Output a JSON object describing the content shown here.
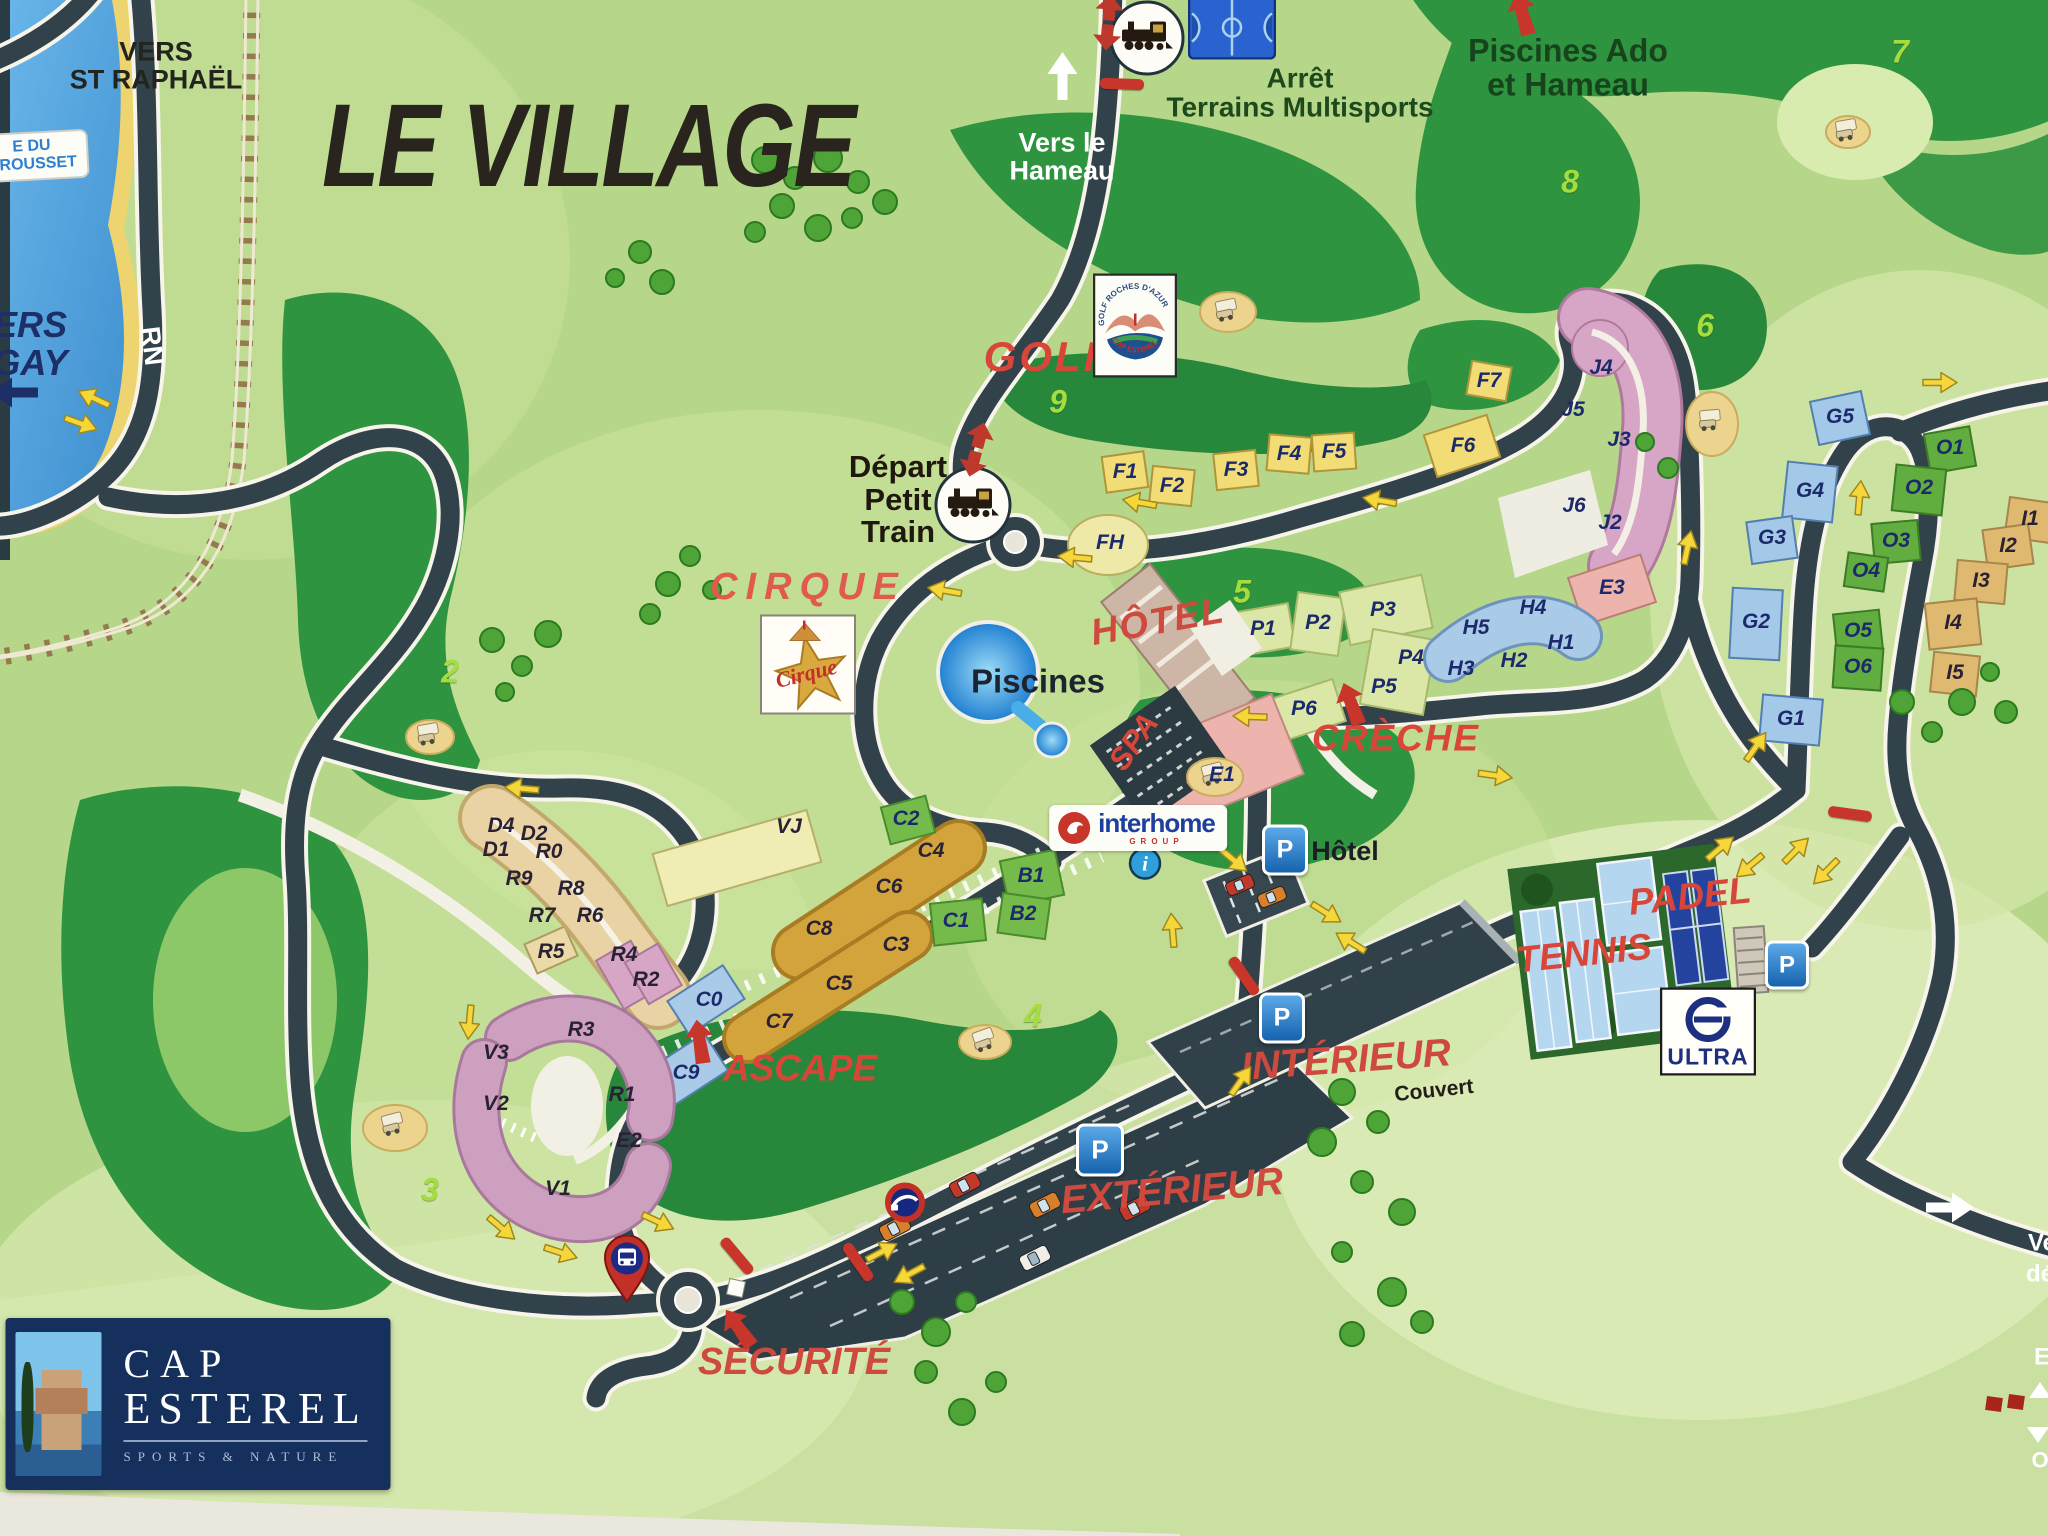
{
  "title": "LE VILLAGE",
  "map_labels": [
    {
      "id": "vers-st-raphael",
      "lines": [
        "VERS",
        "ST RAPHAËL"
      ],
      "x": 156,
      "y": 66,
      "fs": 27,
      "c": "#24241f",
      "it": 0
    },
    {
      "id": "vers-le-hameau",
      "lines": [
        "Vers le",
        "Hameau"
      ],
      "x": 1062,
      "y": 157,
      "fs": 27,
      "c": "#ffffff",
      "it": 0
    },
    {
      "id": "arret-terrains-multisports",
      "lines": [
        "Arrêt",
        "Terrains Multisports"
      ],
      "x": 1300,
      "y": 93,
      "fs": 28,
      "c": "#1d4a1d",
      "it": 0
    },
    {
      "id": "piscines-ado",
      "lines": [
        "Piscines Ado",
        "et Hameau"
      ],
      "x": 1568,
      "y": 68,
      "fs": 32,
      "c": "#17441c",
      "it": 0
    },
    {
      "id": "golf",
      "lines": [
        "GOLF"
      ],
      "x": 1048,
      "y": 357,
      "fs": 42,
      "c": "#d8463a",
      "it": 1,
      "ls": 3
    },
    {
      "id": "depart-petit-train",
      "lines": [
        "Départ",
        "Petit",
        "Train"
      ],
      "x": 898,
      "y": 500,
      "fs": 31,
      "c": "#20180f",
      "it": 0
    },
    {
      "id": "cirque",
      "lines": [
        "CIRQUE"
      ],
      "x": 808,
      "y": 588,
      "fs": 38,
      "c": "#e05a4e",
      "it": 1,
      "ls": 8
    },
    {
      "id": "piscines",
      "lines": [
        "Piscines"
      ],
      "x": 1038,
      "y": 682,
      "fs": 33,
      "c": "#1d2430",
      "it": 0
    },
    {
      "id": "hotel-red",
      "lines": [
        "HÔTEL"
      ],
      "x": 1158,
      "y": 622,
      "fs": 37,
      "c": "#cf4a3e",
      "it": 1,
      "rot": -10,
      "ls": 2
    },
    {
      "id": "spa",
      "lines": [
        "SPA"
      ],
      "x": 1134,
      "y": 742,
      "fs": 31,
      "c": "#d8463a",
      "it": 1,
      "rot": -55
    },
    {
      "id": "creche",
      "lines": [
        "CRÈCHE"
      ],
      "x": 1396,
      "y": 739,
      "fs": 37,
      "c": "#d8463a",
      "it": 1,
      "ls": 2
    },
    {
      "id": "parking-hotel-label",
      "lines": [
        "Hôtel"
      ],
      "x": 1345,
      "y": 851,
      "fs": 27,
      "c": "#1d1d28",
      "it": 0
    },
    {
      "id": "padel",
      "lines": [
        "PADEL"
      ],
      "x": 1690,
      "y": 897,
      "fs": 37,
      "c": "#d8463a",
      "it": 1,
      "rot": -6
    },
    {
      "id": "tennis",
      "lines": [
        "TENNIS"
      ],
      "x": 1584,
      "y": 954,
      "fs": 37,
      "c": "#d8463a",
      "it": 1,
      "rot": -6
    },
    {
      "id": "ascape",
      "lines": [
        "ASCAPE"
      ],
      "x": 800,
      "y": 1069,
      "fs": 37,
      "c": "#d8463a",
      "it": 1
    },
    {
      "id": "interieur",
      "lines": [
        "INTÉRIEUR"
      ],
      "x": 1346,
      "y": 1061,
      "fs": 39,
      "c": "#cf4a3e",
      "it": 1,
      "rot": -4
    },
    {
      "id": "couvert",
      "lines": [
        "Couvert"
      ],
      "x": 1434,
      "y": 1091,
      "fs": 21,
      "c": "#241d18",
      "it": 0,
      "rot": -6
    },
    {
      "id": "exterieur",
      "lines": [
        "EXTÉRIEUR"
      ],
      "x": 1172,
      "y": 1192,
      "fs": 39,
      "c": "#cf4a3e",
      "it": 1,
      "rot": -5
    },
    {
      "id": "securite",
      "lines": [
        "SÉCURITÉ"
      ],
      "x": 794,
      "y": 1363,
      "fs": 38,
      "c": "#cf4a3e",
      "it": 1
    },
    {
      "id": "rn",
      "lines": [
        "RN"
      ],
      "x": 152,
      "y": 346,
      "fs": 27,
      "c": "#ffffff",
      "it": 0,
      "rot": 83
    },
    {
      "id": "vers-agay",
      "lines": [
        "ERS",
        "GAY"
      ],
      "x": 30,
      "y": 344,
      "fs": 36,
      "c": "#1d2f66",
      "it": 1
    },
    {
      "id": "fragment-ve",
      "lines": [
        "Ve"
      ],
      "x": 2042,
      "y": 1243,
      "fs": 24,
      "c": "#ffffff",
      "it": 0
    },
    {
      "id": "fragment-de",
      "lines": [
        "dé"
      ],
      "x": 2040,
      "y": 1274,
      "fs": 24,
      "c": "#ffffff",
      "it": 0
    },
    {
      "id": "fragment-e",
      "lines": [
        "E"
      ],
      "x": 2042,
      "y": 1357,
      "fs": 24,
      "c": "#ffffff",
      "it": 0
    },
    {
      "id": "fragment-o",
      "lines": [
        "O"
      ],
      "x": 2040,
      "y": 1460,
      "fs": 22,
      "c": "#ffffff",
      "it": 0
    }
  ],
  "sign_pourrousset": {
    "lines": [
      "E DU",
      "RROUSSET"
    ],
    "x": 32,
    "y": 156
  },
  "buildings": [
    [
      "F1",
      1125,
      472,
      "n"
    ],
    [
      "F2",
      1172,
      486,
      "n"
    ],
    [
      "F3",
      1236,
      470,
      "n"
    ],
    [
      "F4",
      1289,
      454,
      "n"
    ],
    [
      "F5",
      1334,
      452,
      "n"
    ],
    [
      "F6",
      1463,
      446,
      "n"
    ],
    [
      "F7",
      1489,
      381,
      "n"
    ],
    [
      "FH",
      1110,
      543,
      "n"
    ],
    [
      "J4",
      1601,
      368,
      "n"
    ],
    [
      "J5",
      1573,
      410,
      "n"
    ],
    [
      "J3",
      1619,
      440,
      "n"
    ],
    [
      "J6",
      1574,
      506,
      "n"
    ],
    [
      "J2",
      1610,
      523,
      "n"
    ],
    [
      "E3",
      1612,
      588,
      "n"
    ],
    [
      "E1",
      1222,
      775,
      "n"
    ],
    [
      "H4",
      1533,
      608,
      "n"
    ],
    [
      "H5",
      1476,
      628,
      "n"
    ],
    [
      "H1",
      1561,
      643,
      "n"
    ],
    [
      "H2",
      1514,
      661,
      "n"
    ],
    [
      "H3",
      1461,
      669,
      "n"
    ],
    [
      "P1",
      1263,
      629,
      "n"
    ],
    [
      "P2",
      1318,
      623,
      "n"
    ],
    [
      "P3",
      1383,
      610,
      "n"
    ],
    [
      "P4",
      1411,
      658,
      "n"
    ],
    [
      "P5",
      1384,
      687,
      "n"
    ],
    [
      "P6",
      1304,
      709,
      "n"
    ],
    [
      "G5",
      1840,
      417,
      "n"
    ],
    [
      "G4",
      1810,
      491,
      "n"
    ],
    [
      "G3",
      1772,
      538,
      "n"
    ],
    [
      "G2",
      1756,
      622,
      "n"
    ],
    [
      "G1",
      1791,
      719,
      "n"
    ],
    [
      "O1",
      1950,
      448,
      "n"
    ],
    [
      "O2",
      1919,
      488,
      "n"
    ],
    [
      "O3",
      1896,
      541,
      "n"
    ],
    [
      "O4",
      1866,
      571,
      "n"
    ],
    [
      "O5",
      1858,
      631,
      "n"
    ],
    [
      "O6",
      1858,
      667,
      "n"
    ],
    [
      "I1",
      2030,
      519,
      "d"
    ],
    [
      "I2",
      2008,
      546,
      "d"
    ],
    [
      "I3",
      1981,
      581,
      "d"
    ],
    [
      "I4",
      1953,
      623,
      "d"
    ],
    [
      "I5",
      1955,
      673,
      "d"
    ],
    [
      "B1",
      1031,
      876,
      "n"
    ],
    [
      "B2",
      1023,
      914,
      "n"
    ],
    [
      "C1",
      956,
      921,
      "n"
    ],
    [
      "C2",
      906,
      819,
      "n"
    ],
    [
      "C4",
      931,
      851,
      "d"
    ],
    [
      "C6",
      889,
      887,
      "d"
    ],
    [
      "C8",
      819,
      929,
      "d"
    ],
    [
      "C3",
      896,
      945,
      "d"
    ],
    [
      "C5",
      839,
      984,
      "d"
    ],
    [
      "C7",
      779,
      1022,
      "d"
    ],
    [
      "C0",
      709,
      1000,
      "n"
    ],
    [
      "C9",
      686,
      1073,
      "n"
    ],
    [
      "VJ",
      789,
      827,
      "d"
    ],
    [
      "D4",
      501,
      826,
      "d"
    ],
    [
      "D2",
      534,
      834,
      "d"
    ],
    [
      "D1",
      496,
      850,
      "d"
    ],
    [
      "R0",
      549,
      852,
      "d"
    ],
    [
      "R9",
      519,
      879,
      "d"
    ],
    [
      "R8",
      571,
      889,
      "d"
    ],
    [
      "R7",
      542,
      916,
      "d"
    ],
    [
      "R6",
      590,
      916,
      "d"
    ],
    [
      "R5",
      551,
      952,
      "d"
    ],
    [
      "R4",
      624,
      955,
      "d"
    ],
    [
      "R2",
      646,
      980,
      "d"
    ],
    [
      "R3",
      581,
      1030,
      "d"
    ],
    [
      "V3",
      496,
      1053,
      "d"
    ],
    [
      "V2",
      496,
      1104,
      "d"
    ],
    [
      "R1",
      622,
      1095,
      "d"
    ],
    [
      "E2",
      629,
      1141,
      "d"
    ],
    [
      "V1",
      558,
      1189,
      "d"
    ]
  ],
  "hole_numbers": [
    {
      "n": "2",
      "x": 450,
      "y": 672
    },
    {
      "n": "3",
      "x": 430,
      "y": 1190
    },
    {
      "n": "4",
      "x": 1033,
      "y": 1016
    },
    {
      "n": "5",
      "x": 1242,
      "y": 592
    },
    {
      "n": "6",
      "x": 1705,
      "y": 326
    },
    {
      "n": "7",
      "x": 1900,
      "y": 52
    },
    {
      "n": "8",
      "x": 1570,
      "y": 182
    },
    {
      "n": "9",
      "x": 1058,
      "y": 402
    }
  ],
  "yellow_arrows": [
    [
      95,
      396,
      205
    ],
    [
      80,
      426,
      20
    ],
    [
      522,
      786,
      185
    ],
    [
      467,
      1022,
      95
    ],
    [
      500,
      1230,
      40
    ],
    [
      560,
      1255,
      18
    ],
    [
      657,
      1224,
      25
    ],
    [
      945,
      588,
      190
    ],
    [
      1075,
      555,
      185
    ],
    [
      1140,
      500,
      190
    ],
    [
      1380,
      498,
      190
    ],
    [
      1690,
      548,
      -78
    ],
    [
      1495,
      778,
      8
    ],
    [
      1250,
      714,
      182
    ],
    [
      1758,
      748,
      -55
    ],
    [
      1722,
      850,
      -40
    ],
    [
      1748,
      864,
      140
    ],
    [
      1798,
      852,
      -45
    ],
    [
      1824,
      870,
      135
    ],
    [
      1862,
      498,
      -85
    ],
    [
      1940,
      385,
      0
    ],
    [
      1232,
      862,
      40
    ],
    [
      1325,
      915,
      32
    ],
    [
      1352,
      940,
      212
    ],
    [
      1243,
      1082,
      -55
    ],
    [
      1175,
      930,
      -95
    ],
    [
      883,
      1254,
      -28
    ],
    [
      908,
      1272,
      152
    ]
  ],
  "red_bars": [
    [
      1122,
      84,
      2
    ],
    [
      1244,
      976,
      55
    ],
    [
      858,
      1262,
      55
    ],
    [
      737,
      1256,
      50
    ],
    [
      1850,
      814,
      8
    ]
  ],
  "red_double_arrows": [
    [
      1108,
      25,
      5
    ],
    [
      976,
      452,
      15
    ]
  ],
  "red_pointer_arrows": [
    [
      1352,
      706,
      -20
    ],
    [
      700,
      1044,
      -8
    ],
    [
      740,
      1330,
      -35
    ],
    [
      1523,
      16,
      -15
    ]
  ],
  "white_arrows": [
    [
      1065,
      76,
      -90
    ],
    [
      1950,
      1210,
      0
    ]
  ],
  "navy_arrows": [
    [
      14,
      390,
      180
    ]
  ],
  "parking_icons": [
    [
      1285,
      850,
      40
    ],
    [
      1282,
      1018,
      40
    ],
    [
      1100,
      1150,
      42
    ],
    [
      1787,
      965,
      38
    ]
  ],
  "legend_chips": [
    [
      1994,
      1404
    ],
    [
      2016,
      1402
    ]
  ],
  "legend_triangles": [
    [
      2040,
      1390,
      "up"
    ],
    [
      2038,
      1435,
      "down"
    ]
  ],
  "icons": {
    "info": [
      1145,
      866
    ],
    "bus_stop": [
      627,
      1272
    ],
    "gate": [
      905,
      1205
    ],
    "train_stops": [
      [
        973,
        505
      ],
      [
        1147,
        38
      ]
    ],
    "basketball": [
      1232,
      30
    ]
  },
  "logos": {
    "golf": {
      "x": 1135,
      "y": 328,
      "arc_top": "GOLF ROCHES D'AZUR",
      "arc_bottom": "CAP ESTEREL"
    },
    "cirque": {
      "x": 808,
      "y": 667,
      "script": "Cirque"
    },
    "interhome": {
      "x": 1138,
      "y": 828,
      "name": "interhome",
      "sub": "GROUP"
    },
    "ultra": {
      "x": 1708,
      "y": 1034,
      "name": "ULTRA"
    },
    "cap_esterel": {
      "x": 198,
      "y": 1404,
      "line1": "CAP",
      "line2": "ESTEREL",
      "tagline": "SPORTS & NATURE"
    }
  }
}
